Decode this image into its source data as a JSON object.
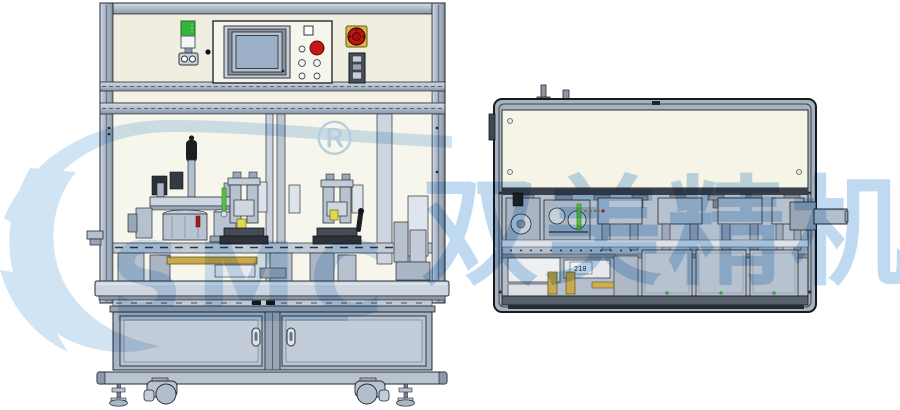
{
  "watermark": {
    "registered_symbol": "®",
    "latin_letters": "SMC",
    "cn_brand_text": "双美精机",
    "color": "#bcd8f0"
  },
  "right_machine": {
    "tiny_plate_label": "210"
  },
  "colors": {
    "panel_cream": "#efeee1",
    "machine_gray": "#b4c0cf",
    "estop_red": "#c31414",
    "tower_green": "#35b33b",
    "gold_bar": "#c9a94e",
    "outline_ink": "#23272d"
  }
}
